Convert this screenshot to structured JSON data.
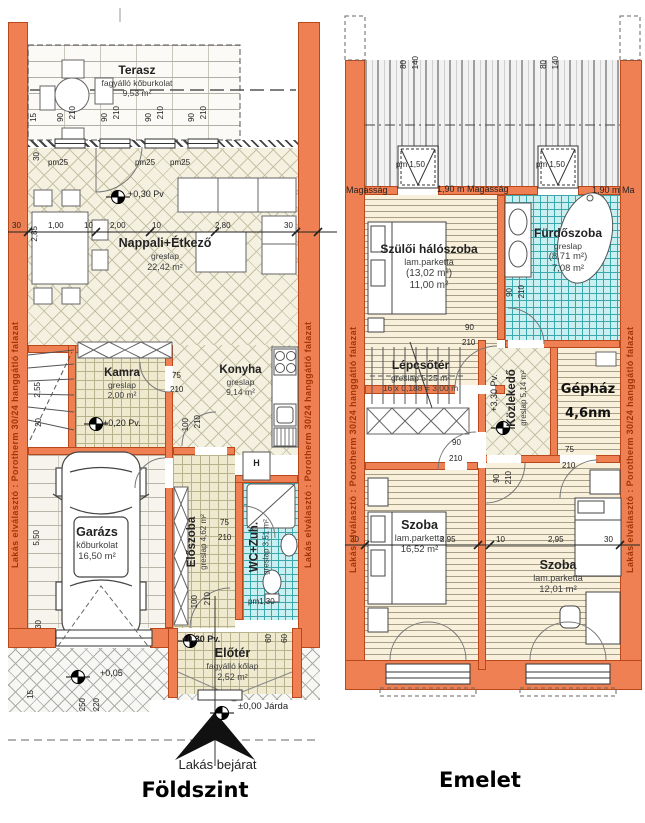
{
  "titles": {
    "foldszint": "Földszint",
    "emelet": "Emelet"
  },
  "wall_label": "Lakás elválasztó : Porotherm 30/24 hanggátló falazat",
  "entrance_label": "Lakás bejárat",
  "foldszint": {
    "rooms": {
      "terasz": {
        "name": "Terasz",
        "finish": "fagyálló kőburkolat",
        "area": "9,53 m²"
      },
      "nappali": {
        "name": "Nappali+Étkező",
        "finish": "greslap",
        "area": "22,42 m²"
      },
      "kamra": {
        "name": "Kamra",
        "finish": "greslap",
        "area": "2,00 m²"
      },
      "konyha": {
        "name": "Konyha",
        "finish": "greslap",
        "area": "9,14 m²"
      },
      "garazs": {
        "name": "Garázs",
        "finish": "kőburkolat",
        "area": "16,50 m²"
      },
      "eloszoba": {
        "name": "Előszoba",
        "finish": "greslap",
        "area": "4,62 m²"
      },
      "wc": {
        "name": "WC+Zuh.",
        "finish": "greslap",
        "area": "3,51 m²"
      },
      "eloter": {
        "name": "Előtér",
        "finish": "fagyálló kőlap",
        "area": "2,52 m²"
      }
    },
    "levels": {
      "pv030": "+0,30 Pv",
      "pv030dot": "+0,30 Pv.",
      "pv020": "+0,20 Pv.",
      "p005": "+0,05",
      "jarda": "±0,00 Járda"
    },
    "parapets": {
      "pm25": "pm25",
      "pm130": "pm1,30"
    },
    "fridge": "H"
  },
  "emelet": {
    "rooms": {
      "szuloi": {
        "name": "Szülői hálószoba",
        "finish": "lam.parketta",
        "area_gross": "(13,02 m²)",
        "area": "11,00 m²"
      },
      "furdo": {
        "name": "Fürdőszoba",
        "finish": "greslap",
        "area_gross": "(8,71 m²)",
        "area": "7,08 m²"
      },
      "lepcso": {
        "name": "Lépcsőtér",
        "finish": "greslap 5,25 m²",
        "steps": "16 x 0,188 = 3,00 m"
      },
      "kozlekedo": {
        "name": "Közlekedő",
        "finish": "greslap",
        "area": "5,14 m²"
      },
      "gephaz": {
        "name": "Gépház",
        "area": "4,6nm"
      },
      "szoba1": {
        "name": "Szoba",
        "finish": "lam.parketta",
        "area": "16,52 m²"
      },
      "szoba2": {
        "name": "Szoba",
        "finish": "lam.parketta",
        "area": "12,01 m²"
      }
    },
    "levels": {
      "pv330": "+3,30 Pv."
    },
    "heights": {
      "magassag": "Magasság",
      "h190": "1,90 m Magasság",
      "h190b": "1,90 m Ma"
    },
    "parapets": {
      "pm150": "pm 1,50"
    }
  },
  "dims": {
    "d10": "10",
    "d15": "15",
    "d20": "20",
    "d30": "30",
    "d60": "60",
    "d75": "75",
    "d80": "80",
    "d90": "90",
    "d100": "100",
    "d140": "140",
    "d210": "210",
    "d220": "220",
    "d250": "250",
    "d100m": "1,00",
    "d200m": "2,00",
    "d255m": "2,55",
    "d280m": "2,80",
    "d285m": "2,85",
    "d295m": "2,95",
    "d550m": "5,50"
  }
}
